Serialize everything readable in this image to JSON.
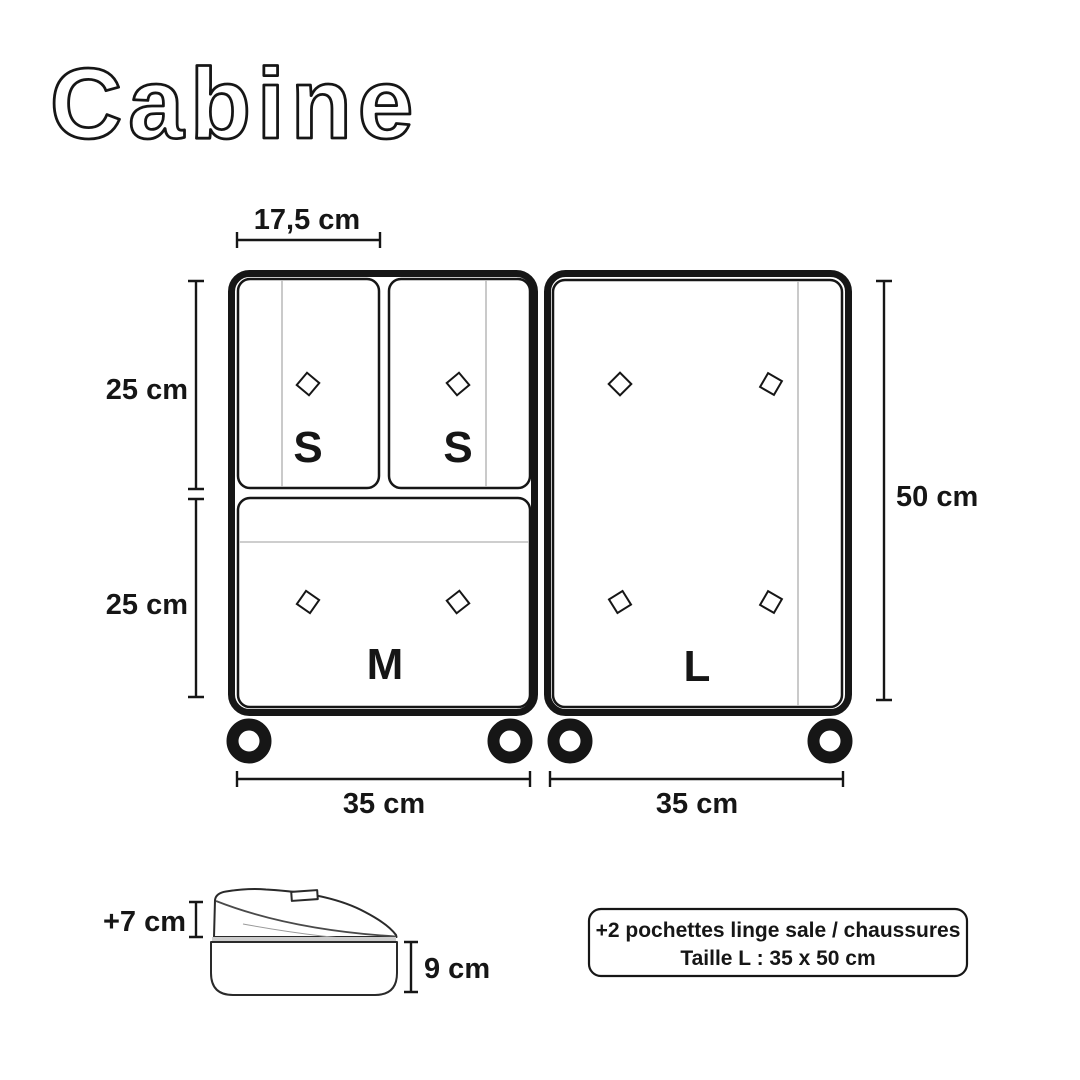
{
  "title": "Cabine",
  "colors": {
    "ink": "#161616",
    "background": "#ffffff",
    "zipper_line": "#bdbdbd"
  },
  "icons": {
    "zipper_pull": "outlined-diamond",
    "wheel": "black-ring"
  },
  "dimensions": {
    "top_width": "17,5 cm",
    "upper_left_height": "25 cm",
    "lower_left_height": "25 cm",
    "right_height": "50 cm",
    "bottom_left_width": "35 cm",
    "bottom_right_width": "35 cm",
    "pouch_expansion_height": "+7 cm",
    "pouch_base_height": "9 cm"
  },
  "cubes": {
    "s1": "S",
    "s2": "S",
    "m": "M",
    "l": "L"
  },
  "note": {
    "line1": "+2 pochettes linge sale / chaussures",
    "line2": "Taille L : 35 x 50 cm"
  }
}
